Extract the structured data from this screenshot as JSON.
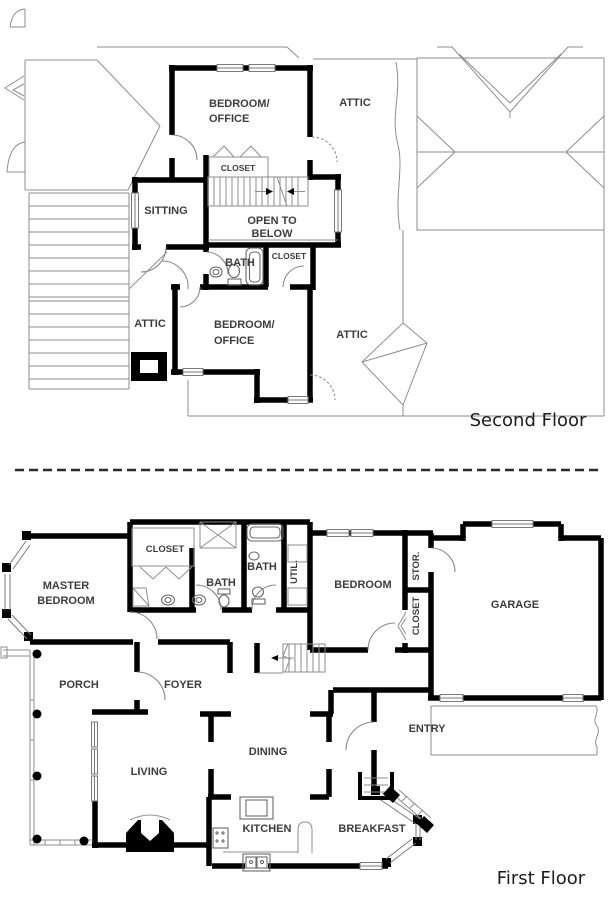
{
  "second_floor": {
    "title": "Second Floor",
    "labels": {
      "bedroom_office_top": [
        "BEDROOM/",
        "OFFICE"
      ],
      "attic_top": "ATTIC",
      "closet_top": "CLOSET",
      "sitting": "SITTING",
      "open_to_below": [
        "OPEN TO",
        "BELOW"
      ],
      "bath": "BATH",
      "closet_mid": "CLOSET",
      "bedroom_office_bottom": [
        "BEDROOM/",
        "OFFICE"
      ],
      "attic_left": "ATTIC",
      "attic_right": "ATTIC"
    }
  },
  "first_floor": {
    "title": "First Floor",
    "labels": {
      "master_bedroom": [
        "MASTER",
        "BEDROOM"
      ],
      "closet": "CLOSET",
      "bath_master": "BATH",
      "bath_hall": "BATH",
      "util": "UTIL.",
      "bedroom": "BEDROOM",
      "stor": "STOR.",
      "closet_bedroom": "CLOSET",
      "garage": "GARAGE",
      "porch": "PORCH",
      "foyer": "FOYER",
      "entry": "ENTRY",
      "living": "LIVING",
      "dining": "DINING",
      "kitchen": "KITCHEN",
      "breakfast": "BREAKFAST"
    }
  },
  "colors": {
    "wall": "#000000",
    "roof_line": "#8e8e8e",
    "label": "#3d3d3d",
    "title": "#1c1c1c",
    "background": "#ffffff"
  }
}
